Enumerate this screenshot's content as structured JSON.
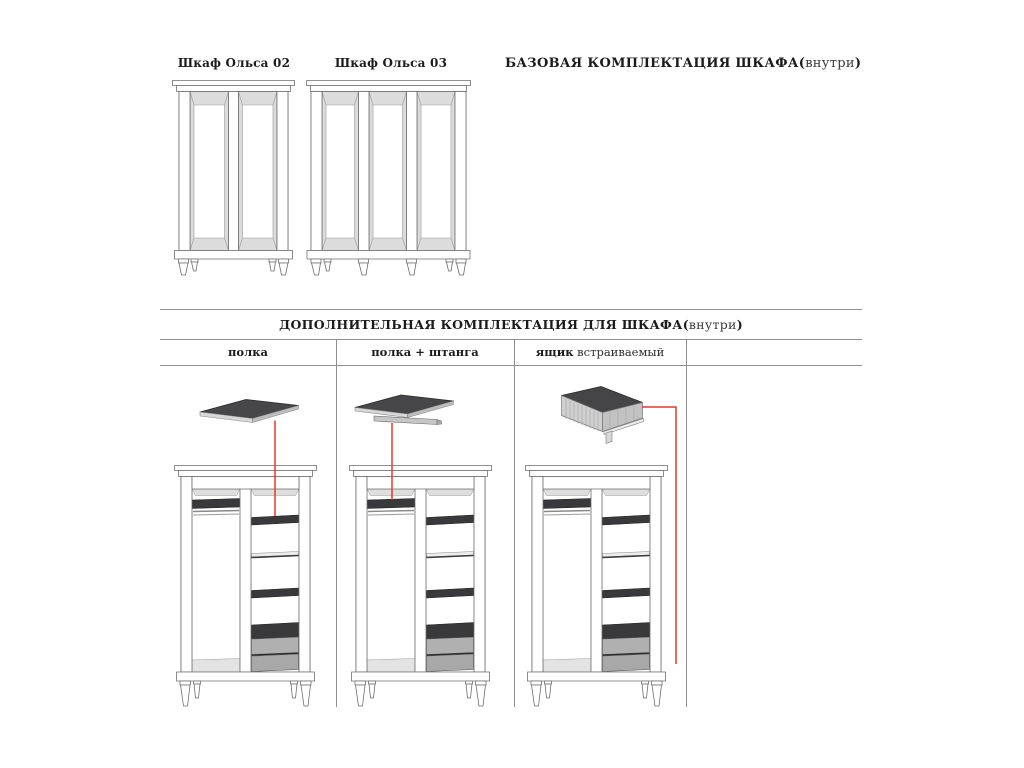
{
  "colors": {
    "accent_red": "#e03a2b",
    "rule_gray": "#8f8f8f",
    "shelf_dark": "#3a3a3c",
    "drawer_gray": "#adadad",
    "panel_gray": "#dcdcdc",
    "text_black": "#1b1b1b"
  },
  "top_section": {
    "wardrobe_labels": [
      {
        "label": "Шкаф Ольса 02"
      },
      {
        "label": "Шкаф Ольса 03"
      }
    ],
    "title": {
      "bold": "БАЗОВАЯ КОМПЛЕКТАЦИЯ ШКАФА(",
      "light": "внутри",
      "close": ")"
    }
  },
  "additional_section": {
    "title": {
      "bold": "ДОПОЛНИТЕЛЬНАЯ КОМПЛЕКТАЦИЯ ДЛЯ ШКАФА(",
      "light": "внутри",
      "close": ")"
    },
    "columns": [
      {
        "bold": "полка",
        "light": ""
      },
      {
        "bold": "полка + штанга",
        "light": ""
      },
      {
        "bold": "ящик",
        "light": " встраиваемый"
      },
      {
        "bold": "",
        "light": ""
      }
    ]
  }
}
